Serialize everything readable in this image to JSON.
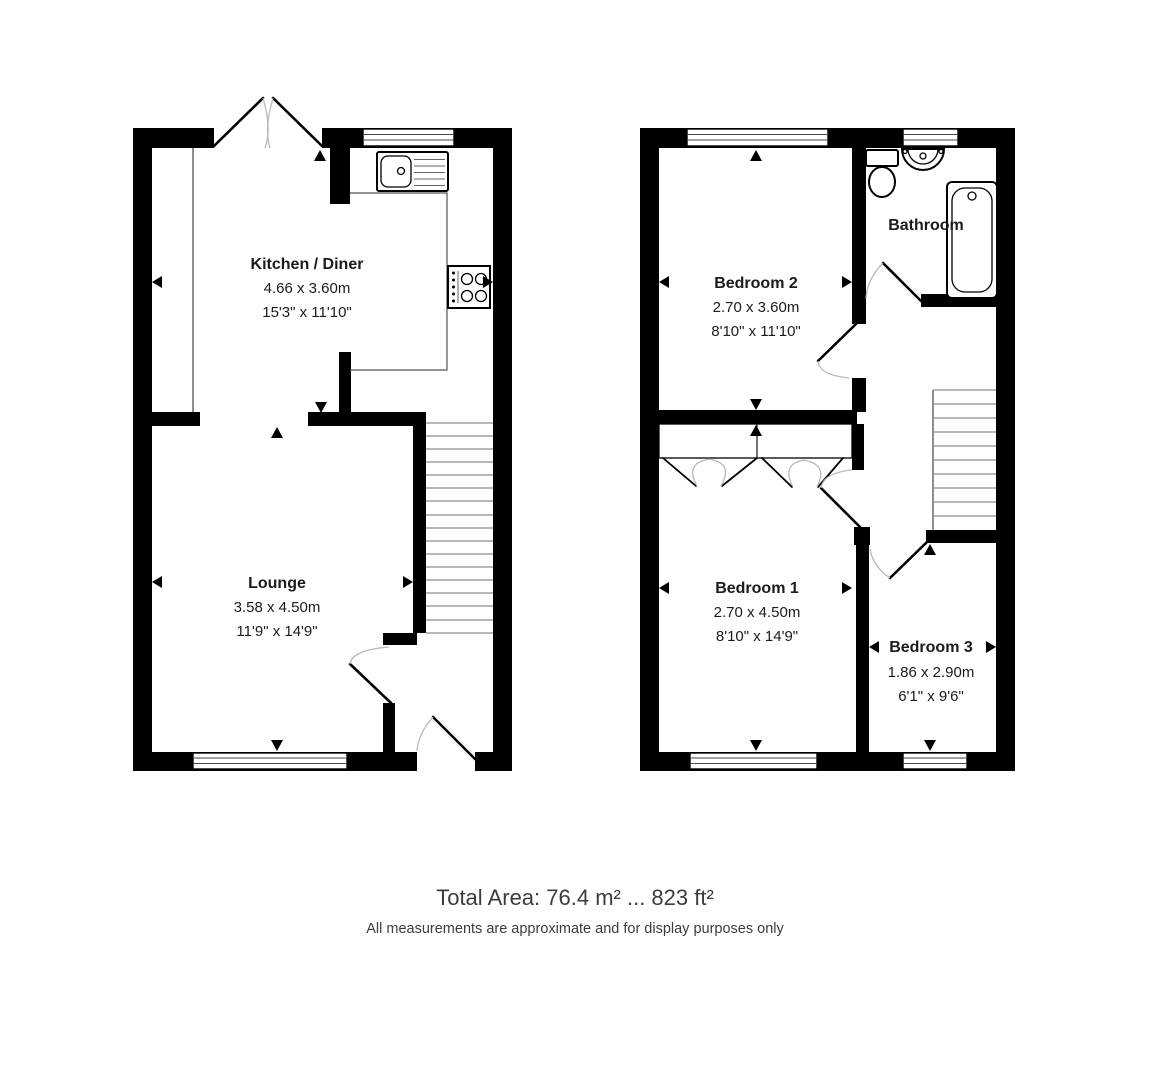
{
  "page": {
    "background": "#ffffff"
  },
  "colors": {
    "wall": "#000000",
    "counter_line": "#555555",
    "stair_line": "#8c8c8c",
    "door_arc": "#b8b8b8",
    "label_text": "#1b1b1b",
    "footer_text": "#3c3c3c"
  },
  "ground_floor": {
    "kitchen_diner": {
      "name": "Kitchen / Diner",
      "size_metric": "4.66 x 3.60m",
      "size_imperial": "15'3\" x 11'10\""
    },
    "lounge": {
      "name": "Lounge",
      "size_metric": "3.58 x 4.50m",
      "size_imperial": "11'9\" x 14'9\""
    }
  },
  "first_floor": {
    "bedroom2": {
      "name": "Bedroom 2",
      "size_metric": "2.70 x 3.60m",
      "size_imperial": "8'10\" x 11'10\""
    },
    "bathroom": {
      "name": "Bathroom"
    },
    "bedroom1": {
      "name": "Bedroom 1",
      "size_metric": "2.70 x 4.50m",
      "size_imperial": "8'10\" x 14'9\""
    },
    "bedroom3": {
      "name": "Bedroom 3",
      "size_metric": "1.86 x 2.90m",
      "size_imperial": "6'1\" x 9'6\""
    }
  },
  "footer": {
    "total_area": "Total Area: 76.4 m² ... 823 ft²",
    "disclaimer": "All measurements are approximate and for display purposes only"
  }
}
